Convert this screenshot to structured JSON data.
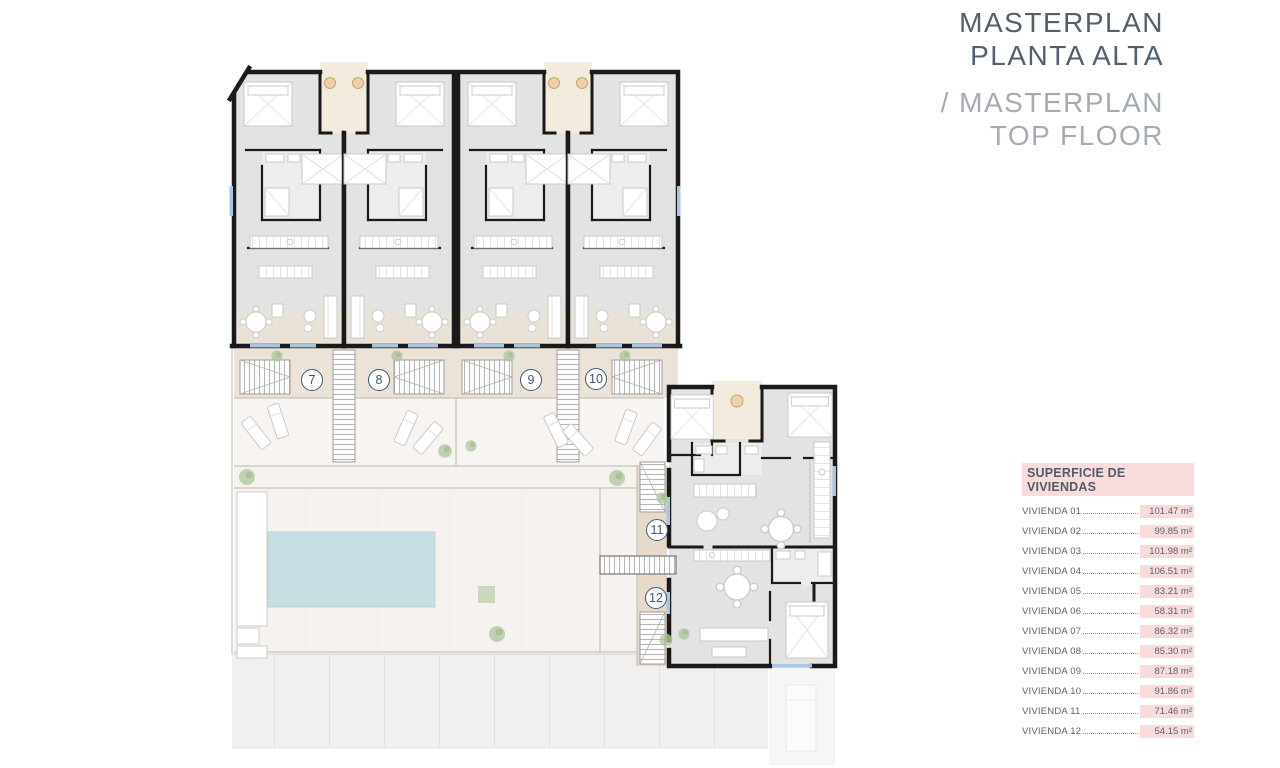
{
  "header": {
    "title_es_line1": "MASTERPLAN",
    "title_es_line2": "PLANTA ALTA",
    "title_en_line1": "/ MASTERPLAN",
    "title_en_line2": "TOP FLOOR"
  },
  "plan": {
    "units": [
      {
        "number": "7"
      },
      {
        "number": "8"
      },
      {
        "number": "9"
      },
      {
        "number": "10"
      },
      {
        "number": "11"
      },
      {
        "number": "12"
      }
    ]
  },
  "areas_table": {
    "title": "SUPERFICIE DE VIVIENDAS",
    "rows": [
      {
        "label": "VIVIENDA 01",
        "value": "101.47 m²"
      },
      {
        "label": "VIVIENDA 02",
        "value": "99.85 m²"
      },
      {
        "label": "VIVIENDA 03",
        "value": "101.98 m²"
      },
      {
        "label": "VIVIENDA 04",
        "value": "106.51 m²"
      },
      {
        "label": "VIVIENDA 05",
        "value": "83.21 m²"
      },
      {
        "label": "VIVIENDA 06",
        "value": "58.31 m²"
      },
      {
        "label": "VIVIENDA 07",
        "value": "86.32 m²"
      },
      {
        "label": "VIVIENDA 08",
        "value": "85.30 m²"
      },
      {
        "label": "VIVIENDA 09",
        "value": "87.18 m²"
      },
      {
        "label": "VIVIENDA 10",
        "value": "91.86 m²"
      },
      {
        "label": "VIVIENDA 11",
        "value": "71.46 m²"
      },
      {
        "label": "VIVIENDA 12",
        "value": "54.15 m²"
      }
    ]
  },
  "colors": {
    "accent_pink": "#f8dcdc",
    "badge_blue": "#3e5a75",
    "title_dark": "#525f6d",
    "title_light": "#a4abb2",
    "pool_blue": "#c7dfe3",
    "wall_black": "#1a1a1a",
    "terrace_beige": "#ebe3d8"
  }
}
